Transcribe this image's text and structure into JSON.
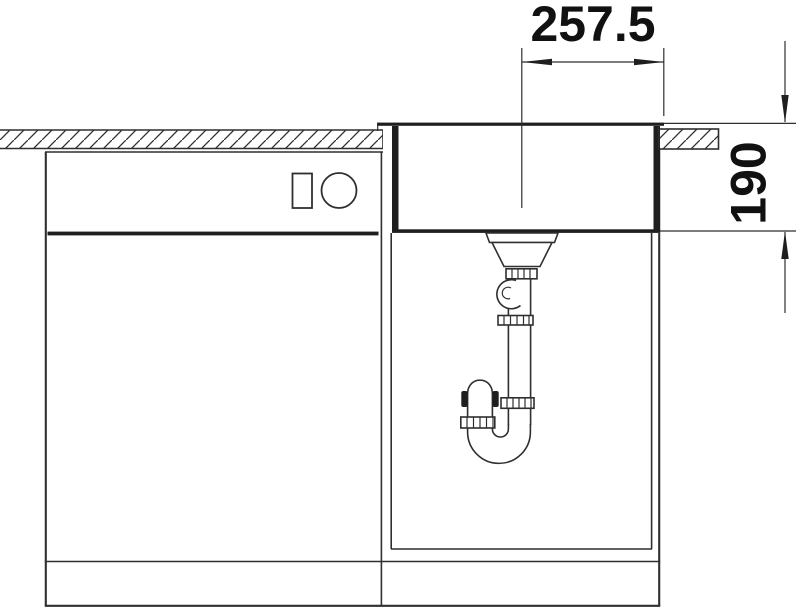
{
  "diagram": {
    "type": "technical-installation-drawing",
    "dimensions": {
      "width_label": "257.5",
      "depth_label": "190"
    },
    "colors": {
      "line": "#2f2f2f",
      "dark_fill": "#1f1f1f",
      "text": "#111111",
      "background": "#ffffff"
    }
  }
}
